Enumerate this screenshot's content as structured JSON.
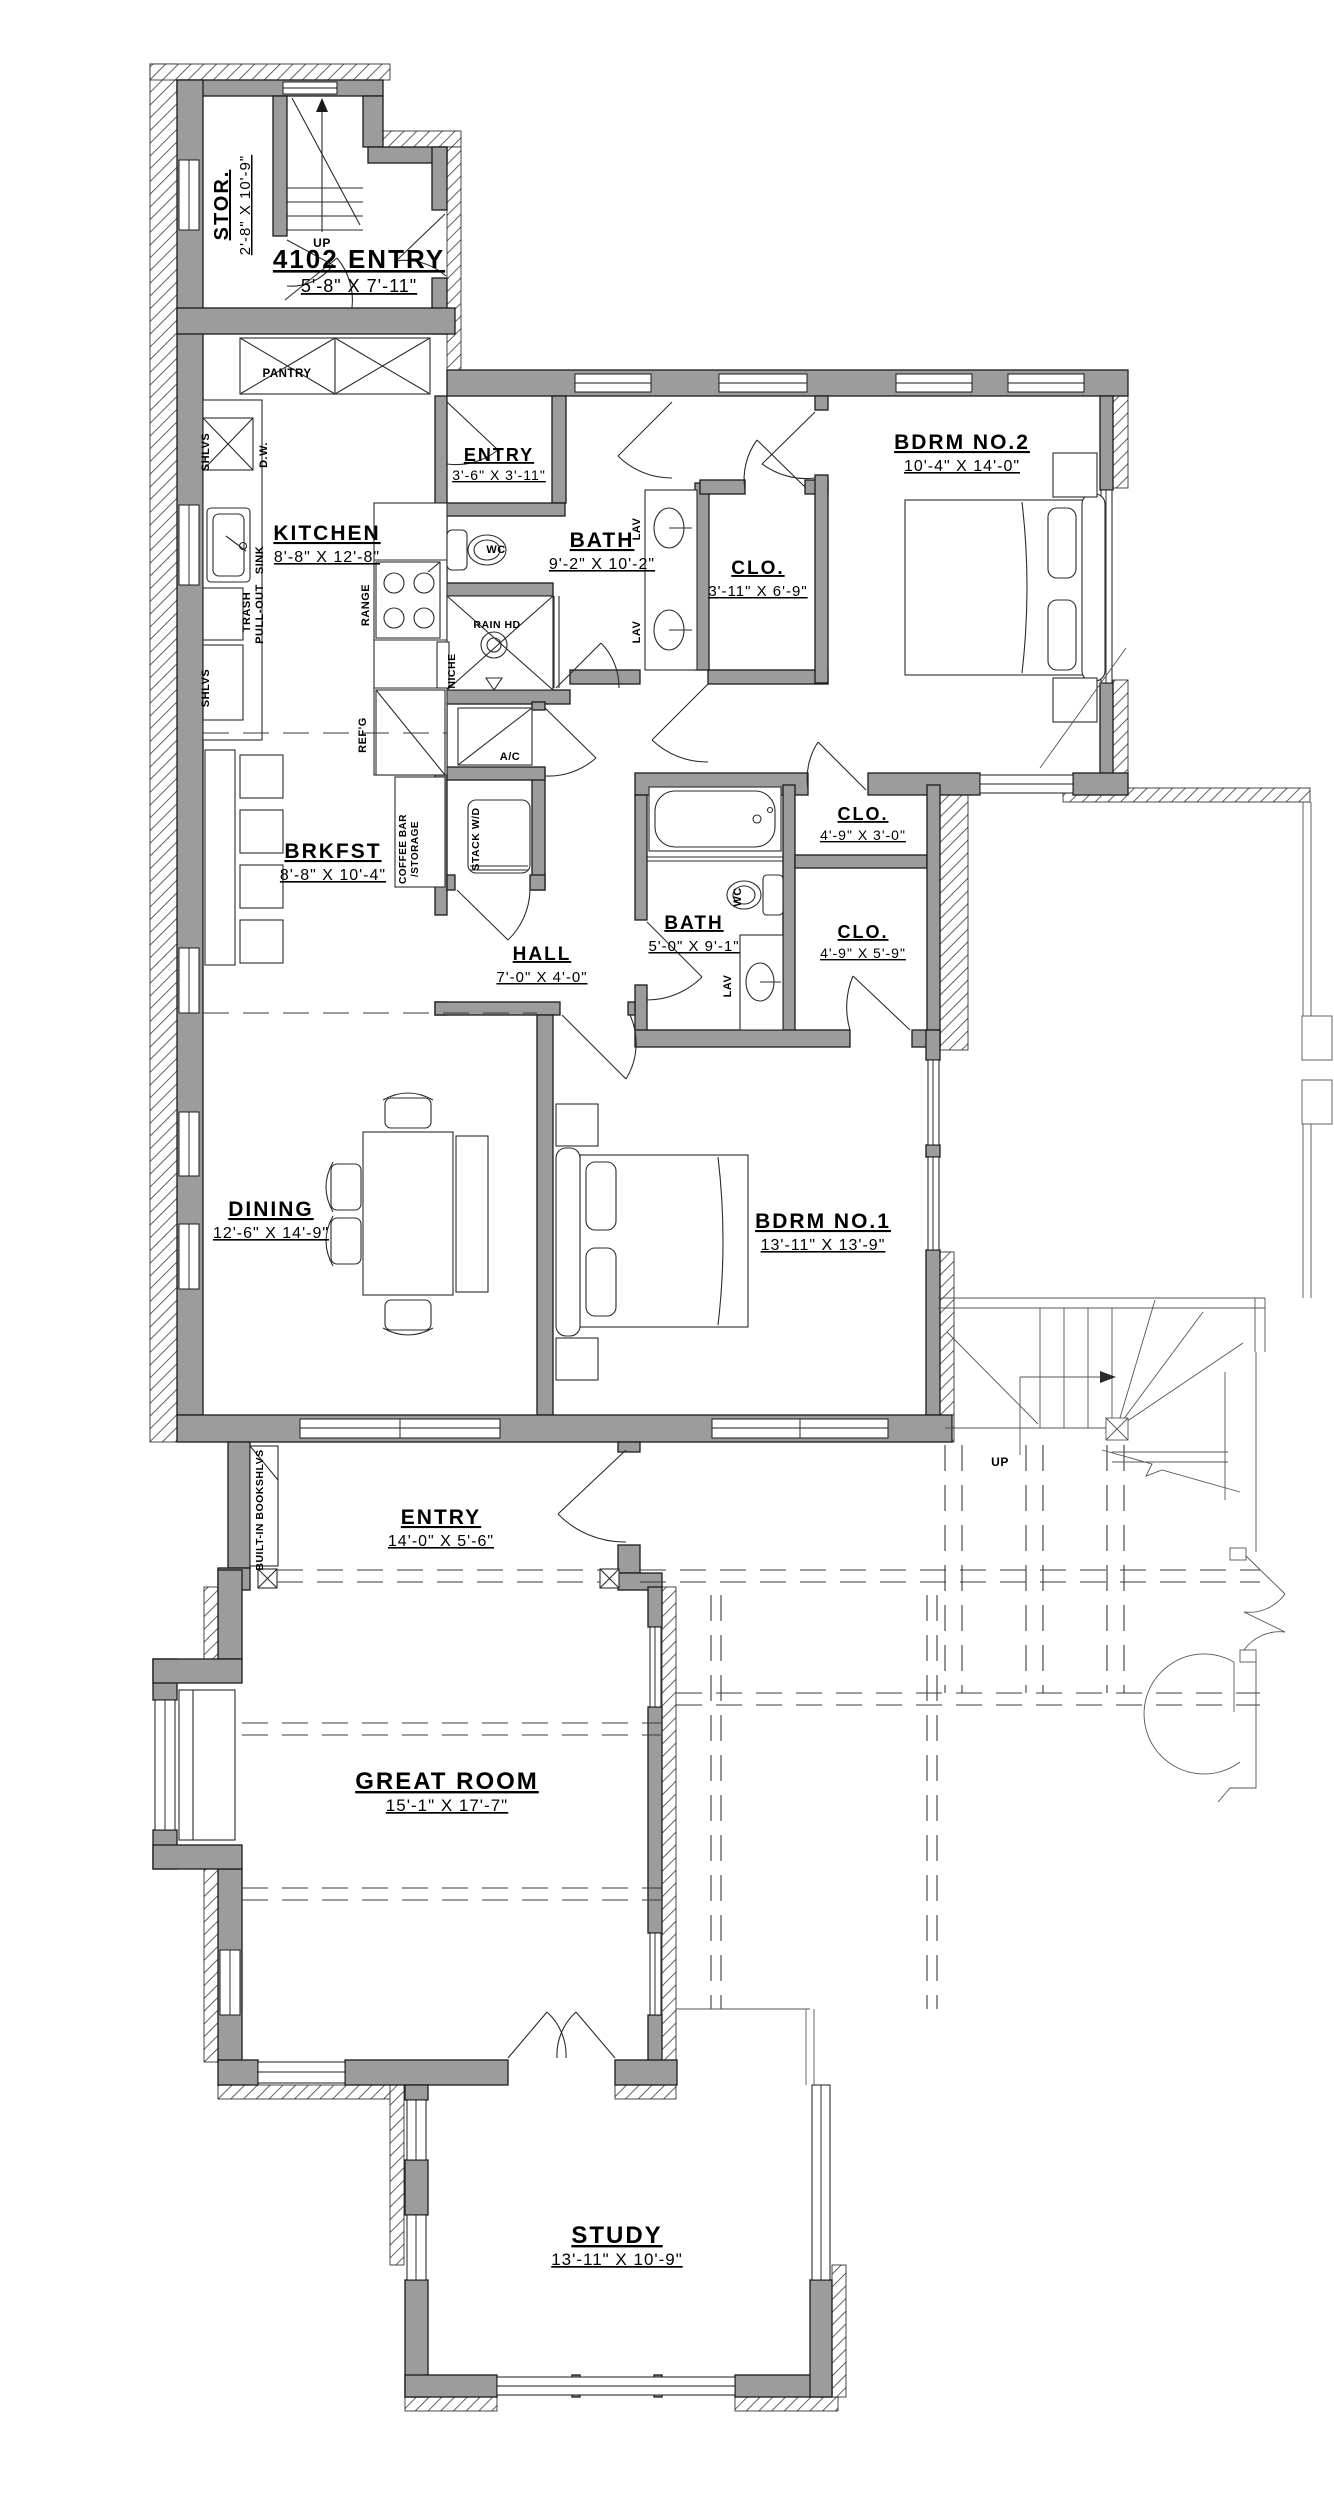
{
  "drawing_colors": {
    "wall_fill": "#9c9c9c",
    "line": "#1b1b1b",
    "background": "#ffffff"
  },
  "rooms": [
    {
      "id": "stor",
      "name": "STOR.",
      "dims": "2'-8\" X 10'-9\"",
      "x": 228,
      "y": 205,
      "rotate": -90,
      "name_size": 20,
      "dim_size": 15
    },
    {
      "id": "entry-4102",
      "name": "4102 ENTRY",
      "dims": "5'-8\" X 7'-11\"",
      "x": 359,
      "y": 268,
      "name_size": 26,
      "dim_size": 18,
      "dim_offset": 24
    },
    {
      "id": "kitchen",
      "name": "KITCHEN",
      "dims": "8'-8\" X 12'-8\"",
      "x": 327,
      "y": 540
    },
    {
      "id": "bath-entry",
      "name": "ENTRY",
      "dims": "3'-6\" X 3'-11\"",
      "x": 499,
      "y": 461,
      "name_size": 18,
      "dim_size": 14,
      "dim_offset": 19
    },
    {
      "id": "bath1",
      "name": "BATH",
      "dims": "9'-2\" X 10'-2\"",
      "x": 602,
      "y": 547
    },
    {
      "id": "clo-bath1",
      "name": "CLO.",
      "dims": "3'-11\" X 6'-9\"",
      "x": 758,
      "y": 574,
      "name_size": 19,
      "dim_size": 15
    },
    {
      "id": "bdrm2",
      "name": "BDRM NO.2",
      "dims": "10'-4\" X 14'-0\"",
      "x": 962,
      "y": 449
    },
    {
      "id": "brkfst",
      "name": "BRKFST",
      "dims": "8'-8\" X 10'-4\"",
      "x": 333,
      "y": 858
    },
    {
      "id": "hall",
      "name": "HALL",
      "dims": "7'-0\" X 4'-0\"",
      "x": 542,
      "y": 960,
      "name_size": 19,
      "dim_size": 15
    },
    {
      "id": "bath2",
      "name": "BATH",
      "dims": "5'-0\" X 9'-1\"",
      "x": 694,
      "y": 929,
      "name_size": 19,
      "dim_size": 15
    },
    {
      "id": "clo-upper",
      "name": "CLO.",
      "dims": "4'-9\" X 3'-0\"",
      "x": 863,
      "y": 820,
      "name_size": 18,
      "dim_size": 14,
      "dim_offset": 20
    },
    {
      "id": "clo-lower",
      "name": "CLO.",
      "dims": "4'-9\" X 5'-9\"",
      "x": 863,
      "y": 938,
      "name_size": 18,
      "dim_size": 14,
      "dim_offset": 20
    },
    {
      "id": "dining",
      "name": "DINING",
      "dims": "12'-6\" X 14'-9\"",
      "x": 271,
      "y": 1216
    },
    {
      "id": "bdrm1",
      "name": "BDRM NO.1",
      "dims": "13'-11\" X 13'-9\"",
      "x": 823,
      "y": 1228
    },
    {
      "id": "entry-main",
      "name": "ENTRY",
      "dims": "14'-0\" X 5'-6\"",
      "x": 441,
      "y": 1524
    },
    {
      "id": "great-room",
      "name": "GREAT ROOM",
      "dims": "15'-1\" X 17'-7\"",
      "x": 447,
      "y": 1789,
      "name_size": 24,
      "dim_size": 17
    },
    {
      "id": "study",
      "name": "STUDY",
      "dims": "13'-11\" X 10'-9\"",
      "x": 617,
      "y": 2243,
      "name_size": 24,
      "dim_size": 17
    }
  ],
  "fixture_labels": [
    {
      "name": "label-up-stair-top",
      "text": "UP",
      "x": 322,
      "y": 247,
      "size": 12
    },
    {
      "name": "label-pantry",
      "text": "PANTRY",
      "x": 287,
      "y": 377,
      "size": 11.5
    },
    {
      "name": "label-shlvs-upper",
      "text": "SHLVS",
      "x": 209,
      "y": 452,
      "rotate": -90,
      "size": 11
    },
    {
      "name": "label-dishwasher",
      "text": "D.W.",
      "x": 267,
      "y": 455,
      "rotate": -90,
      "size": 11
    },
    {
      "name": "label-sink",
      "text": "SINK",
      "x": 263,
      "y": 560,
      "rotate": -90,
      "size": 11
    },
    {
      "name": "label-trash",
      "text": "TRASH",
      "x": 250,
      "y": 612,
      "rotate": -90,
      "size": 11
    },
    {
      "name": "label-pullout",
      "text": "PULL-OUT",
      "x": 263,
      "y": 614,
      "rotate": -90,
      "size": 11
    },
    {
      "name": "label-shlvs-lower",
      "text": "SHLVS",
      "x": 209,
      "y": 688,
      "rotate": -90,
      "size": 11
    },
    {
      "name": "label-range",
      "text": "RANGE",
      "x": 369,
      "y": 605,
      "rotate": -90,
      "size": 11
    },
    {
      "name": "label-refg",
      "text": "REF'G",
      "x": 366,
      "y": 735,
      "rotate": -90,
      "size": 11
    },
    {
      "name": "label-wc-bath1",
      "text": "WC",
      "x": 496,
      "y": 553,
      "size": 11
    },
    {
      "name": "label-rain-hd",
      "text": "RAIN HD",
      "x": 497,
      "y": 628,
      "size": 10.5
    },
    {
      "name": "label-niche",
      "text": "NICHE",
      "x": 455,
      "y": 671,
      "rotate": -90,
      "size": 10.5
    },
    {
      "name": "label-lav1",
      "text": "LAV",
      "x": 640,
      "y": 529,
      "rotate": -90,
      "size": 11
    },
    {
      "name": "label-lav2",
      "text": "LAV",
      "x": 640,
      "y": 632,
      "rotate": -90,
      "size": 11
    },
    {
      "name": "label-ac",
      "text": "A/C",
      "x": 510,
      "y": 760,
      "size": 11
    },
    {
      "name": "label-stack-wd",
      "text": "STACK W/D",
      "x": 479,
      "y": 839,
      "rotate": -90,
      "size": 10.5
    },
    {
      "name": "label-coffee-bar",
      "text": "COFFEE BAR",
      "x": 406,
      "y": 849,
      "rotate": -90,
      "size": 10
    },
    {
      "name": "label-storage",
      "text": "/STORAGE",
      "x": 418,
      "y": 849,
      "rotate": -90,
      "size": 10
    },
    {
      "name": "label-wc-bath2",
      "text": "WC",
      "x": 741,
      "y": 897,
      "rotate": -90,
      "size": 11
    },
    {
      "name": "label-lav3",
      "text": "LAV",
      "x": 731,
      "y": 986,
      "rotate": -90,
      "size": 11
    },
    {
      "name": "label-bookshlvs",
      "text": "BUILT-IN BOOKSHLVS",
      "x": 263,
      "y": 1510,
      "rotate": -90,
      "size": 10.5
    },
    {
      "name": "label-up-stair-right",
      "text": "UP",
      "x": 1000,
      "y": 1466,
      "size": 12
    }
  ]
}
